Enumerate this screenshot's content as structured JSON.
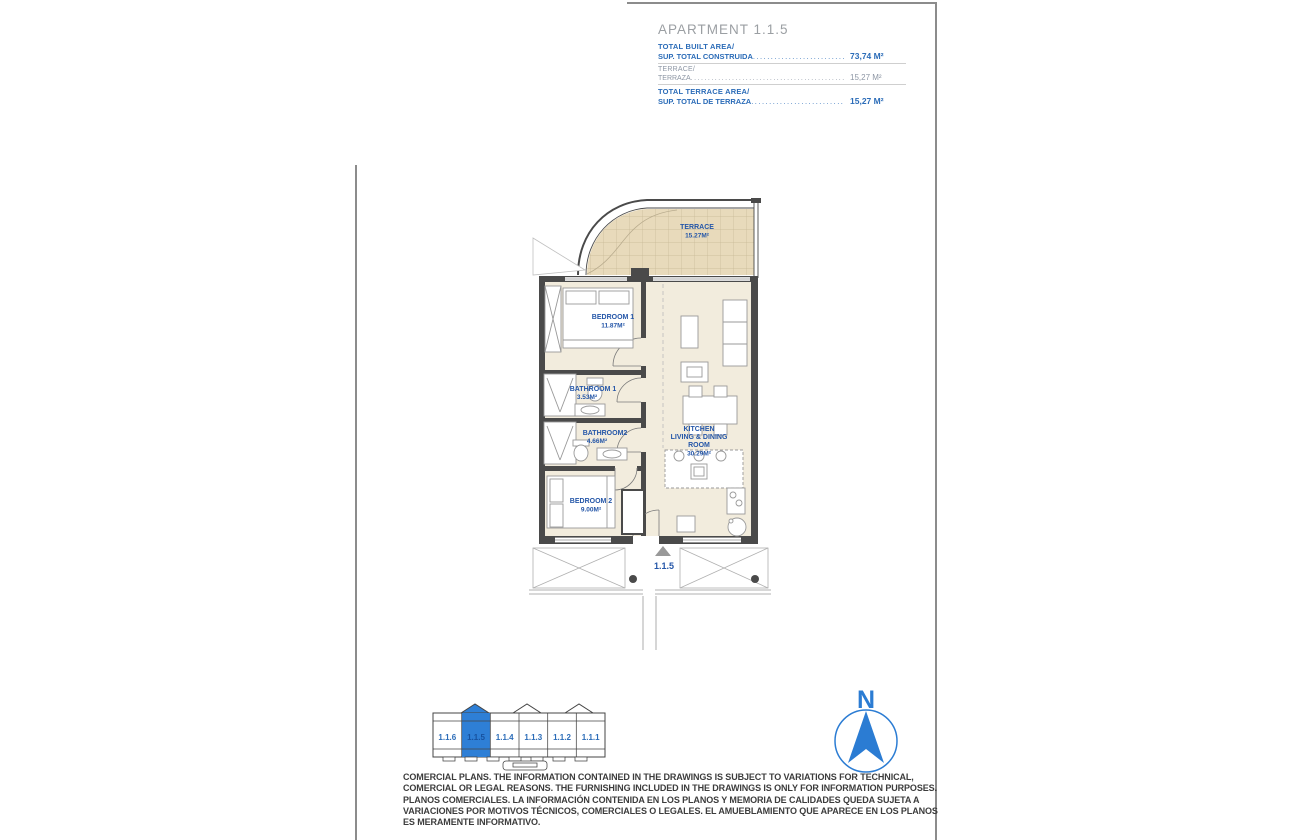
{
  "sheet": {
    "title": "APARTMENT 1.1.5",
    "info_rows": [
      {
        "line1": "TOTAL BUILT AREA/",
        "line2": "SUP. TOTAL CONSTRUIDA",
        "leader": "....................................",
        "value": "73,74 M²",
        "style": "primary"
      },
      {
        "line1": "TERRACE/",
        "line2": "TERRAZA",
        "leader": "..............................................................",
        "value": "15,27 M²",
        "style": "secondary"
      },
      {
        "line1": "TOTAL TERRACE AREA/",
        "line2": "SUP. TOTAL DE TERRAZA",
        "leader": "....................................",
        "value": "15,27 M²",
        "style": "primary"
      }
    ]
  },
  "plan": {
    "terrace": {
      "name": "TERRACE",
      "area": "15.27M²"
    },
    "bedroom1": {
      "name": "BEDROOM 1",
      "area": "11.87M²"
    },
    "bathroom1": {
      "name": "BATHROOM 1",
      "area": "3.53M²"
    },
    "bathroom2": {
      "name": "BATHROOM2",
      "area": "4.66M²"
    },
    "bedroom2": {
      "name": "BEDROOM 2",
      "area": "9.00M²"
    },
    "kitchen": {
      "name_l1": "KITCHEN",
      "name_l2": "LIVING & DINING",
      "name_l3": "ROOM",
      "area": "30.29M²"
    },
    "entrance_label": "1.1.5"
  },
  "keyplan": {
    "units": [
      "1.1.6",
      "1.1.5",
      "1.1.4",
      "1.1.3",
      "1.1.2",
      "1.1.1"
    ],
    "highlighted": "1.1.5"
  },
  "compass": {
    "north_label": "N"
  },
  "disclaimer": {
    "lines": [
      "COMERCIAL PLANS. THE INFORMATION CONTAINED IN THE DRAWINGS IS SUBJECT TO VARIATIONS FOR TECHNICAL,",
      "COMERCIAL OR LEGAL REASONS. THE FURNISHING INCLUDED IN THE DRAWINGS IS ONLY FOR INFORMATION PURPOSES.",
      "PLANOS COMERCIALES. LA INFORMACIÓN CONTENIDA EN LOS PLANOS Y MEMORIA DE CALIDADES QUEDA SUJETA A",
      "VARIACIONES POR MOTIVOS TÉCNICOS, COMERCIALES O LEGALES. EL AMUEBLAMIENTO QUE APARECE EN LOS PLANOS",
      "ES MERAMENTE INFORMATIVO."
    ]
  },
  "colors": {
    "accent_blue": "#2b6cb8",
    "label_blue": "#2456a8",
    "highlight_blue": "#2e7fd6",
    "wall_gray": "#4a4a4a",
    "terrace_tile": "#e8dabb",
    "floor_beige": "#f2ecdd",
    "title_gray": "#9b9fa3"
  }
}
